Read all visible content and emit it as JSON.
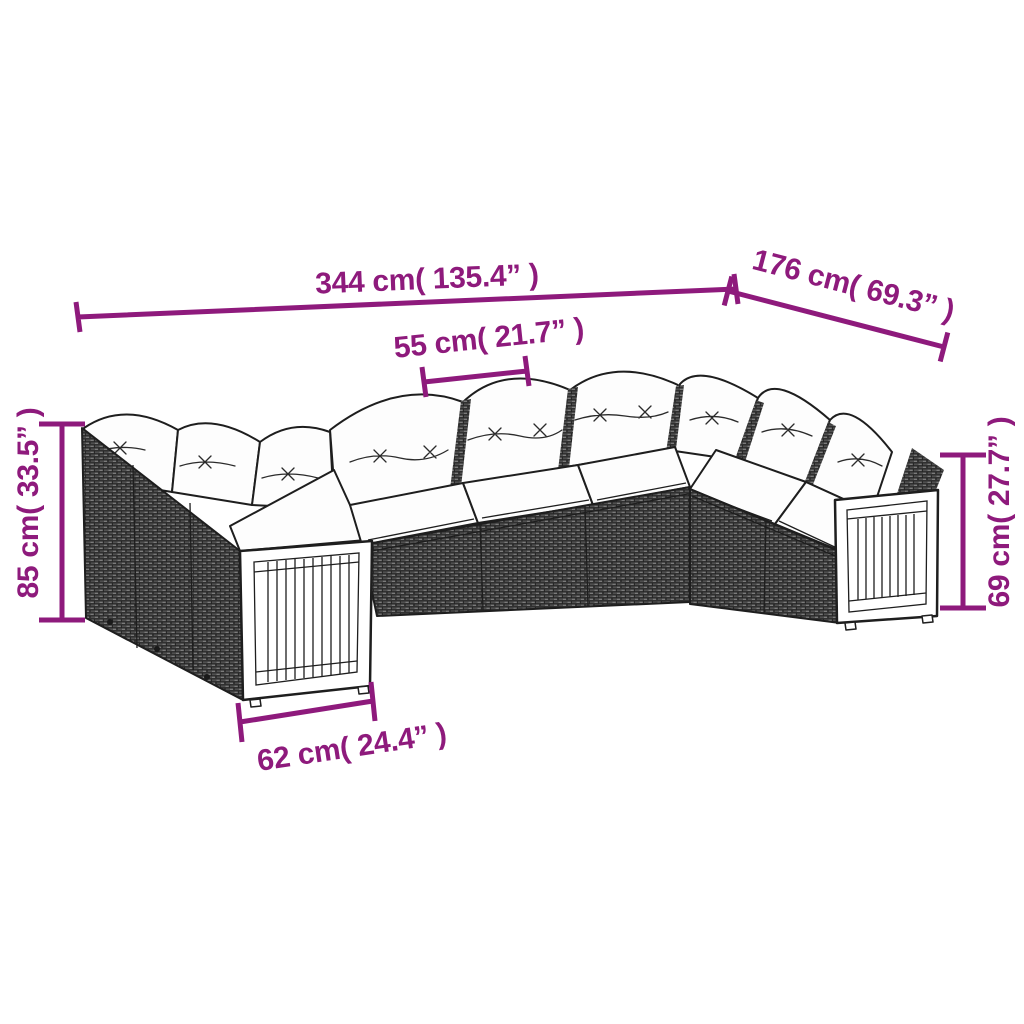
{
  "diagram": {
    "subject": "wicker-sectional-sofa-set-with-cushions",
    "accent_color": "#8E1A7C",
    "dimensions": {
      "total_width": "344 cm( 135.4” )",
      "side_depth": "176 cm( 69.3” )",
      "seat_width": "55 cm( 21.7” )",
      "back_height": "85 cm( 33.5” )",
      "arm_height": "69 cm( 27.7” )",
      "arm_depth": "62 cm( 24.4” )"
    }
  }
}
